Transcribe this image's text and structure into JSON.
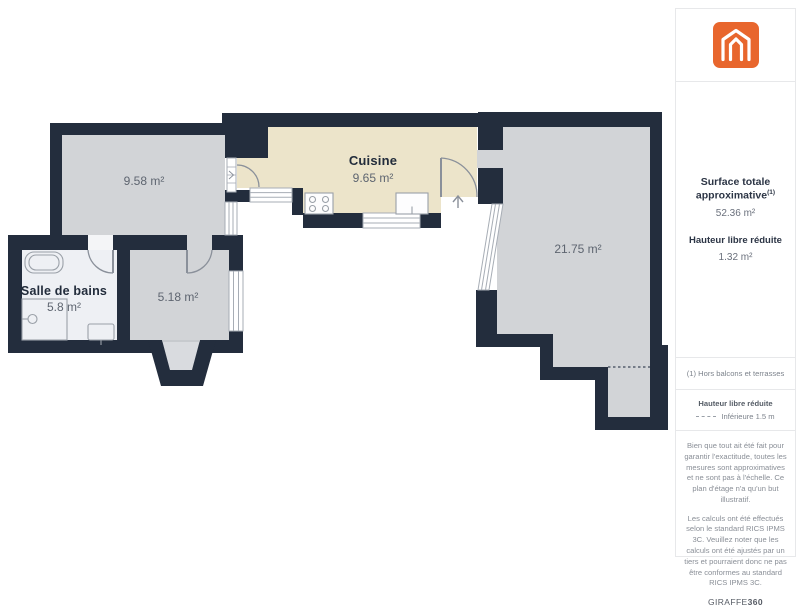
{
  "plan": {
    "rooms": [
      {
        "name": "Cuisine",
        "area": "9.65 m²"
      },
      {
        "name": "",
        "area": "9.58 m²"
      },
      {
        "name": "Salle de bains",
        "area": "5.8 m²"
      },
      {
        "name": "",
        "area": "5.18 m²"
      },
      {
        "name": "",
        "area": "21.75 m²"
      }
    ]
  },
  "sidebar": {
    "summary": {
      "surface_label": "Surface totale approximative",
      "surface_superscript": "(1)",
      "surface_value": "52.36 m²",
      "height_label": "Hauteur libre réduite",
      "height_value": "1.32 m²"
    },
    "footnote": "(1) Hors balcons et terrasses",
    "legend": {
      "title": "Hauteur libre réduite",
      "item": "Inférieure 1.5 m"
    },
    "disclaimer1": "Bien que tout ait été fait pour garantir l'exactitude, toutes les mesures sont approximatives et ne sont pas à l'échelle. Ce plan d'étage n'a qu'un but illustratif.",
    "disclaimer2": "Les calculs ont été effectués selon le standard RICS IPMS 3C. Veuillez noter que les calculs ont été ajustés par un tiers et pourraient donc ne pas être conformes au standard RICS IPMS 3C.",
    "brand": {
      "name": "GIRAFFE",
      "suffix": "360"
    }
  },
  "colors": {
    "accent_orange": "#e8662d",
    "wall": "#232d3d",
    "floor_gray": "#d2d4d7",
    "kitchen_beige": "#ece4ca",
    "bathroom_floor": "#eef0f4"
  }
}
